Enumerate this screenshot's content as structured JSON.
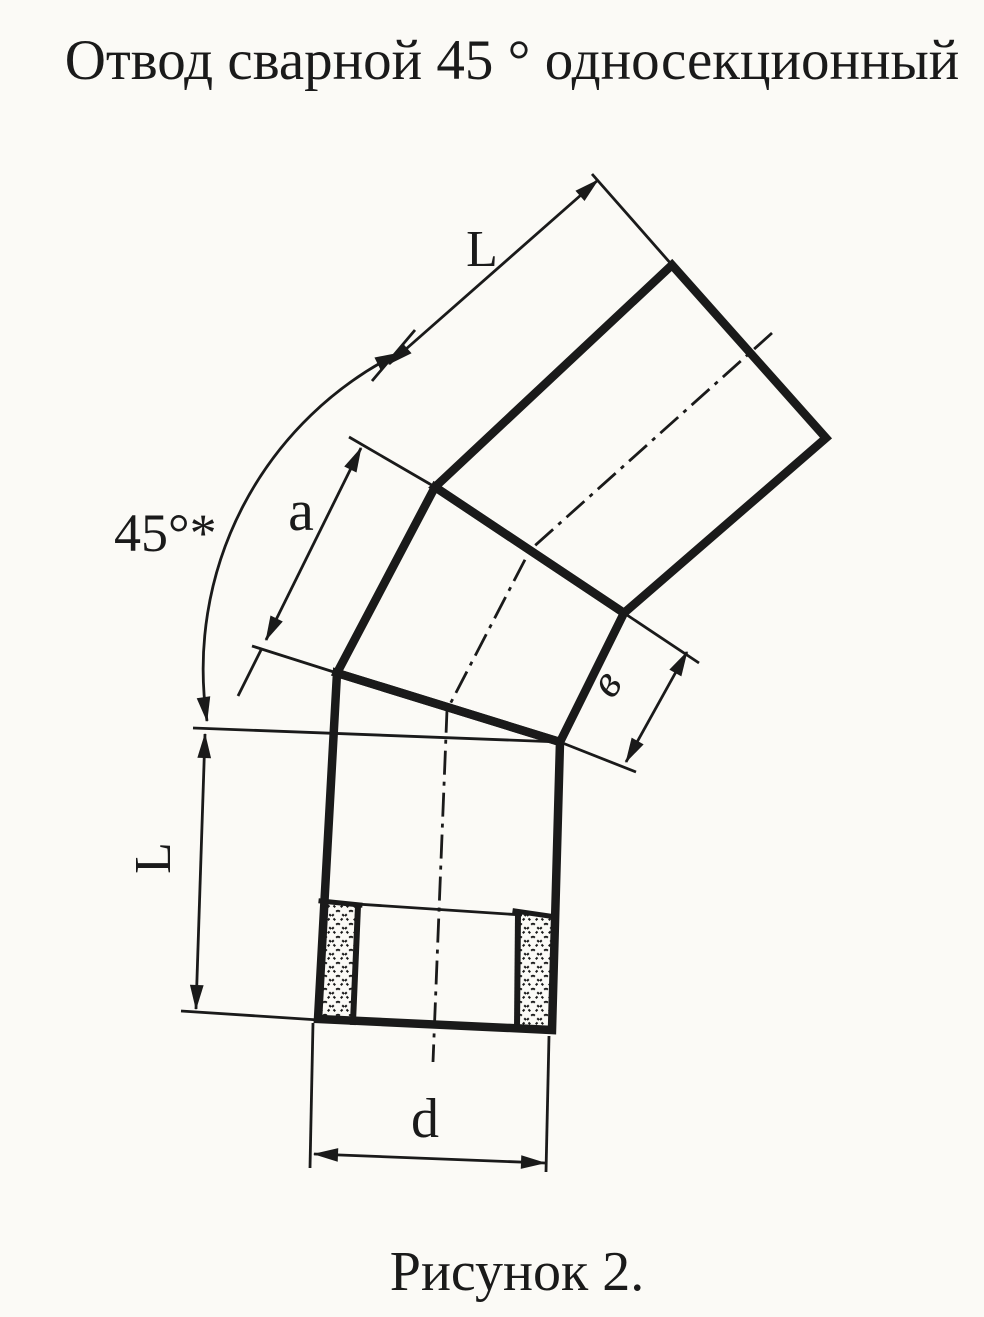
{
  "page": {
    "title": "Отвод сварной 45 ° односекционный",
    "caption": "Рисунок 2.",
    "ink_color": "#1a1a1a",
    "paper_color": "#fbfaf6"
  },
  "diagram": {
    "labels": {
      "segment_length_top": "L",
      "gore_edge_length": "a",
      "bend_angle": "45°*",
      "gore_face_width": "в",
      "segment_length_left": "L",
      "pipe_diameter": "d"
    }
  }
}
